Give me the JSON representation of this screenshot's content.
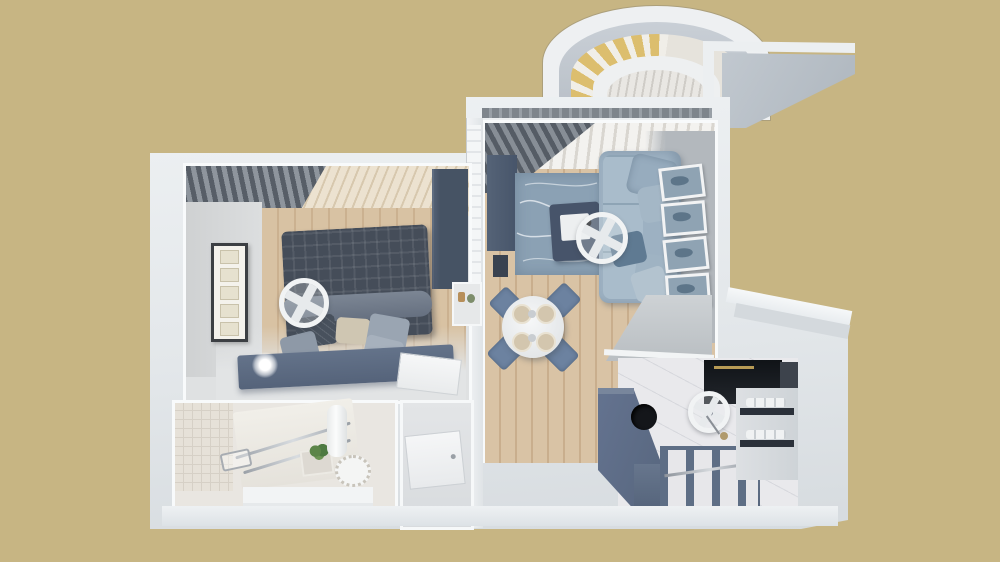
{
  "scene": {
    "kind": "3d-rendered-floor-plan",
    "view": "top-down isometric cutaway",
    "apartment_type": "one-bedroom apartment",
    "background_color": "#c7b583",
    "visible_text": "none"
  },
  "palette": {
    "background_tan": "#c7b583",
    "wall_white": "#eef1f3",
    "wall_shadow_gray": "#d6dbdf",
    "interior_gray_wall": "#b3b8bd",
    "wood_floor_light": "#d9c3a5",
    "wood_floor_dark": "#c9ae8d",
    "slate_blue_furniture": "#56657c",
    "dark_bed_plaid": "#454d59",
    "light_blue_sofa": "#9db1c2",
    "rug_blue": "#8ba1b4",
    "curtain_dark_gray": "#575e67",
    "appliance_black": "#16191e",
    "marble_floor": "#e9e9ec",
    "window_glazing_yellow": "#dcbe6e",
    "plant_green": "#4e7a42",
    "plate_beige": "#d3c6ae"
  },
  "rooms": {
    "bedroom": {
      "name": "bedroom",
      "furniture": [
        "double-bed-with-plaid-blanket",
        "pillows",
        "headboard-platform-with-lamps",
        "wardrobe",
        "shelf-niche",
        "framed-botanical-prints",
        "gray-curtains",
        "wood-slat-ceiling",
        "ceiling-fan",
        "open-door"
      ]
    },
    "bathroom": {
      "name": "bathroom",
      "furniture": [
        "mosaic-tile-wall",
        "vanity-counter",
        "sink-with-plant",
        "chrome-towel-rails",
        "glass-shower-shelf",
        "water-heater-cylinder",
        "toilet",
        "floor-steps"
      ]
    },
    "hallway": {
      "name": "hallway",
      "furniture": [
        "open-white-door"
      ]
    },
    "living_room": {
      "name": "living-room",
      "furniture": [
        "light-blue-sofa-with-cushions",
        "blue-area-rug",
        "coffee-table-with-tray",
        "tv-cabinet",
        "speaker",
        "gallery-wall-four-frames",
        "sheer-curtains",
        "dark-gray-curtain",
        "ceiling-fan",
        "round-dining-table",
        "four-blue-chairs",
        "table-settings"
      ]
    },
    "kitchen": {
      "name": "kitchen",
      "furniture": [
        "l-shaped-slate-counter",
        "black-round-sink",
        "black-appliance-column",
        "marble-floor",
        "bench-joists",
        "wall-shelves-with-plates",
        "ceiling-fan-with-pull-chain",
        "doorway"
      ]
    },
    "balcony": {
      "name": "balcony",
      "features": [
        "arched-roof",
        "semicircular-window-with-yellow-glazing",
        "roof-overhang"
      ]
    }
  },
  "icons": {
    "ceiling_fan": "white ring with crossed blades",
    "lamp_glow": "radial white glow",
    "plant": "green cluster dots"
  }
}
